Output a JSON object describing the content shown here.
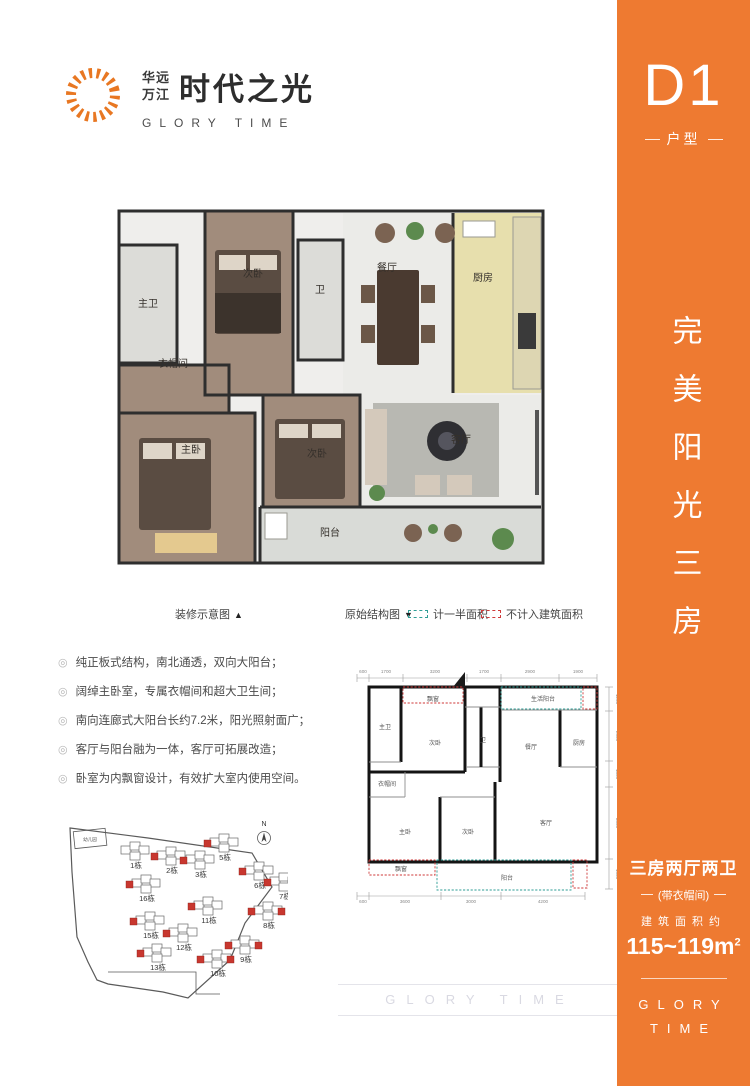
{
  "brand": {
    "cn_small_line1": "华远",
    "cn_small_line2": "万江",
    "cn_large": "时代之光",
    "en": "GLORY TIME",
    "icon_color": "#e87722"
  },
  "sidebar": {
    "bg_color": "#ee7a31",
    "unit_code": "D1",
    "unit_type_label": "户型",
    "slogan_vertical": "完美阳光三房",
    "spec_title": "三房两厅两卫",
    "spec_sub": "(带衣帽间)",
    "area_label": "建筑面积约",
    "area_value": "115~119m",
    "area_sup": "2",
    "brand_en_line1": "GLORY",
    "brand_en_line2": "TIME"
  },
  "legend": {
    "decorated_label": "装修示意图",
    "decorated_marker": "▲",
    "original_label": "原始结构图",
    "original_marker": "▼",
    "half_area_label": "计一半面积",
    "half_area_color": "#2f9e96",
    "excluded_label": "不计入建筑面积",
    "excluded_color": "#cf3a3a"
  },
  "features": {
    "items": [
      "纯正板式结构，南北通透，双向大阳台；",
      "阔绰主卧室，专属衣帽间和超大卫生间；",
      "南向连廊式大阳台长约7.2米，阳光照射面广；",
      "客厅与阳台融为一体，客厅可拓展改造；",
      "卧室为内飘窗设计，有效扩大室内使用空间。"
    ]
  },
  "main_plan": {
    "rooms": [
      {
        "t": "主卫",
        "x": 33,
        "y": 112
      },
      {
        "t": "次卧",
        "x": 138,
        "y": 82
      },
      {
        "t": "卫",
        "x": 205,
        "y": 98
      },
      {
        "t": "餐厅",
        "x": 272,
        "y": 76
      },
      {
        "t": "厨房",
        "x": 368,
        "y": 86
      },
      {
        "t": "衣帽间",
        "x": 58,
        "y": 172
      },
      {
        "t": "主卧",
        "x": 76,
        "y": 258
      },
      {
        "t": "次卧",
        "x": 202,
        "y": 262
      },
      {
        "t": "客厅",
        "x": 346,
        "y": 248
      },
      {
        "t": "阳台",
        "x": 215,
        "y": 341
      }
    ]
  },
  "schematic": {
    "rooms": [
      {
        "t": "主卫",
        "x": 40,
        "y": 67
      },
      {
        "t": "飘窗",
        "x": 88,
        "y": 39
      },
      {
        "t": "次卧",
        "x": 90,
        "y": 83
      },
      {
        "t": "卫",
        "x": 138,
        "y": 80
      },
      {
        "t": "生活阳台",
        "x": 198,
        "y": 39
      },
      {
        "t": "餐厅",
        "x": 186,
        "y": 87
      },
      {
        "t": "厨房",
        "x": 234,
        "y": 83
      },
      {
        "t": "衣帽间",
        "x": 42,
        "y": 124
      },
      {
        "t": "主卧",
        "x": 60,
        "y": 172
      },
      {
        "t": "次卧",
        "x": 123,
        "y": 172
      },
      {
        "t": "客厅",
        "x": 201,
        "y": 163
      },
      {
        "t": "飘窗",
        "x": 56,
        "y": 209
      },
      {
        "t": "阳台",
        "x": 162,
        "y": 218
      }
    ],
    "dims_top": [
      {
        "t": "600",
        "x": 18,
        "y": 11
      },
      {
        "t": "1700",
        "x": 41,
        "y": 11
      },
      {
        "t": "3200",
        "x": 90,
        "y": 11
      },
      {
        "t": "1700",
        "x": 139,
        "y": 11
      },
      {
        "t": "2900",
        "x": 185,
        "y": 11
      },
      {
        "t": "1900",
        "x": 233,
        "y": 11
      }
    ],
    "dims_bottom": [
      {
        "t": "600",
        "x": 18,
        "y": 241
      },
      {
        "t": "3600",
        "x": 60,
        "y": 241
      },
      {
        "t": "3000",
        "x": 126,
        "y": 241
      },
      {
        "t": "4200",
        "x": 198,
        "y": 241
      }
    ],
    "dims_right": [
      {
        "t": "1200",
        "x": 271,
        "y": 37,
        "rot": 90
      },
      {
        "t": "2500",
        "x": 271,
        "y": 74,
        "rot": 90
      },
      {
        "t": "1300",
        "x": 271,
        "y": 112,
        "rot": 90
      },
      {
        "t": "3600",
        "x": 271,
        "y": 161,
        "rot": 90
      },
      {
        "t": "1500",
        "x": 271,
        "y": 212,
        "rot": 90
      }
    ]
  },
  "site_plan": {
    "north_label": "N",
    "kindergarten_label": "幼儿园",
    "buildings": [
      {
        "t": "1栋",
        "x": 88,
        "y": 52,
        "red": 0
      },
      {
        "t": "2栋",
        "x": 124,
        "y": 57,
        "red": 1
      },
      {
        "t": "3栋",
        "x": 153,
        "y": 61,
        "red": 1
      },
      {
        "t": "5栋",
        "x": 177,
        "y": 44,
        "red": 1
      },
      {
        "t": "6栋",
        "x": 212,
        "y": 72,
        "red": 1
      },
      {
        "t": "7栋",
        "x": 237,
        "y": 83,
        "red": 2
      },
      {
        "t": "16栋",
        "x": 99,
        "y": 85,
        "red": 1
      },
      {
        "t": "11栋",
        "x": 161,
        "y": 107,
        "red": 1
      },
      {
        "t": "8栋",
        "x": 221,
        "y": 112,
        "red": 2
      },
      {
        "t": "15栋",
        "x": 103,
        "y": 122,
        "red": 1
      },
      {
        "t": "12栋",
        "x": 136,
        "y": 134,
        "red": 1
      },
      {
        "t": "9栋",
        "x": 198,
        "y": 146,
        "red": 2
      },
      {
        "t": "13栋",
        "x": 110,
        "y": 154,
        "red": 1
      },
      {
        "t": "10栋",
        "x": 170,
        "y": 160,
        "red": 2
      }
    ]
  },
  "watermark": {
    "text": "GLORY TIME"
  }
}
